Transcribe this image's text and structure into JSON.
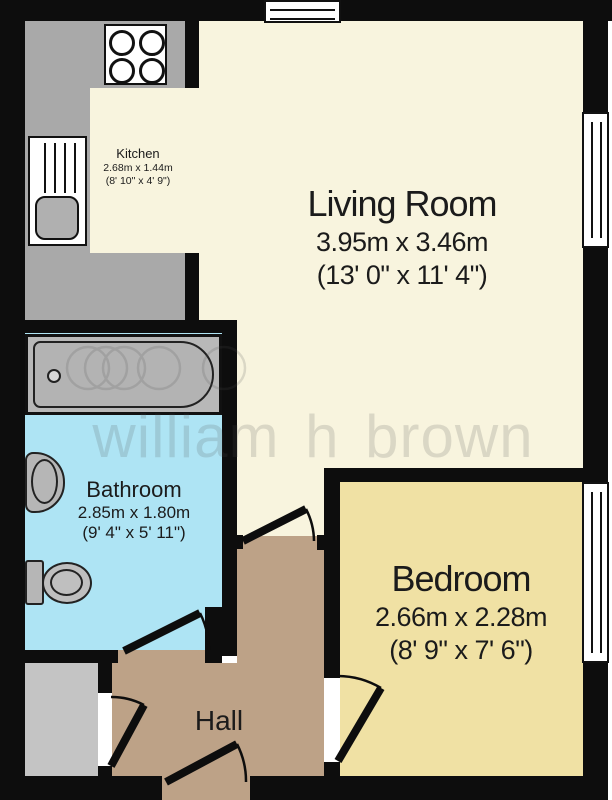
{
  "title": "Flat floor plan",
  "watermark": {
    "text": "william h brown"
  },
  "rooms": {
    "kitchen": {
      "name": "Kitchen",
      "metric": "2.68m x 1.44m",
      "imperial": "(8' 10\" x 4' 9\")"
    },
    "living": {
      "name": "Living Room",
      "metric": "3.95m x 3.46m",
      "imperial": "(13' 0\" x 11' 4\")"
    },
    "bathroom": {
      "name": "Bathroom",
      "metric": "2.85m x 1.80m",
      "imperial": "(9' 4\" x 5' 11\")"
    },
    "bedroom": {
      "name": "Bedroom",
      "metric": "2.66m x 2.28m",
      "imperial": "(8' 9\" x 7' 6\")"
    },
    "hall": {
      "name": "Hall"
    }
  },
  "colors": {
    "wall": "#0d0d0d",
    "living_kitchen_floor": "#f8f4de",
    "bedroom_floor": "#f0e1a4",
    "bathroom_floor": "#aee4f4",
    "hall_floor": "#bda287",
    "counter": "#a9a9a9",
    "cupboard": "#c4c4c4",
    "fixture": "#b6b6b6",
    "text": "#1b1b1b"
  }
}
